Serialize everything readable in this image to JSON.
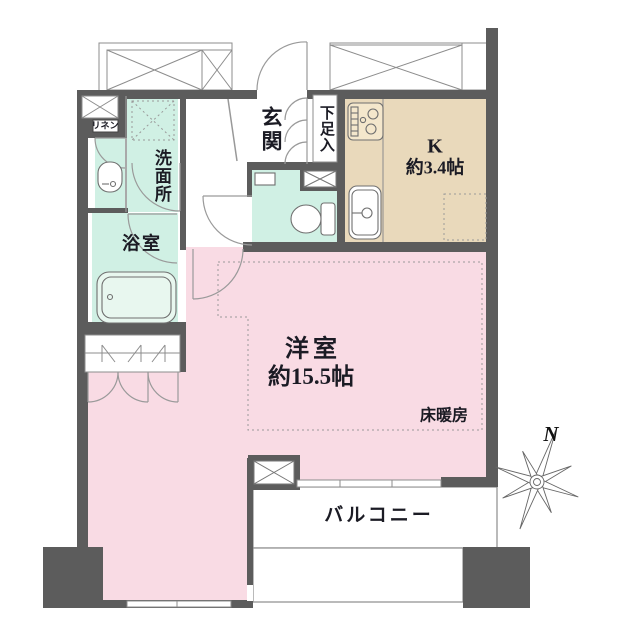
{
  "plan": {
    "rooms": {
      "genkan": {
        "label": "玄関"
      },
      "shoe_storage": {
        "label": "下足入"
      },
      "kitchen": {
        "label": "K",
        "size": "約3.4帖"
      },
      "washroom": {
        "label": "洗面所"
      },
      "linen": {
        "label": "リネン"
      },
      "bathroom": {
        "label": "浴室"
      },
      "living_room": {
        "label": "洋室",
        "size": "約15.5帖"
      },
      "floor_heating": {
        "label": "床暖房"
      },
      "balcony": {
        "label": "バルコニー"
      }
    },
    "compass": {
      "north_label": "N"
    },
    "colors": {
      "wall": "#5c5c5c",
      "living_pink": "#f9dbe4",
      "wet_area_green": "#d0f0e4",
      "kitchen_beige": "#e9d9bb",
      "line_gray": "#8c8c8c",
      "text": "#1b1b24"
    }
  }
}
